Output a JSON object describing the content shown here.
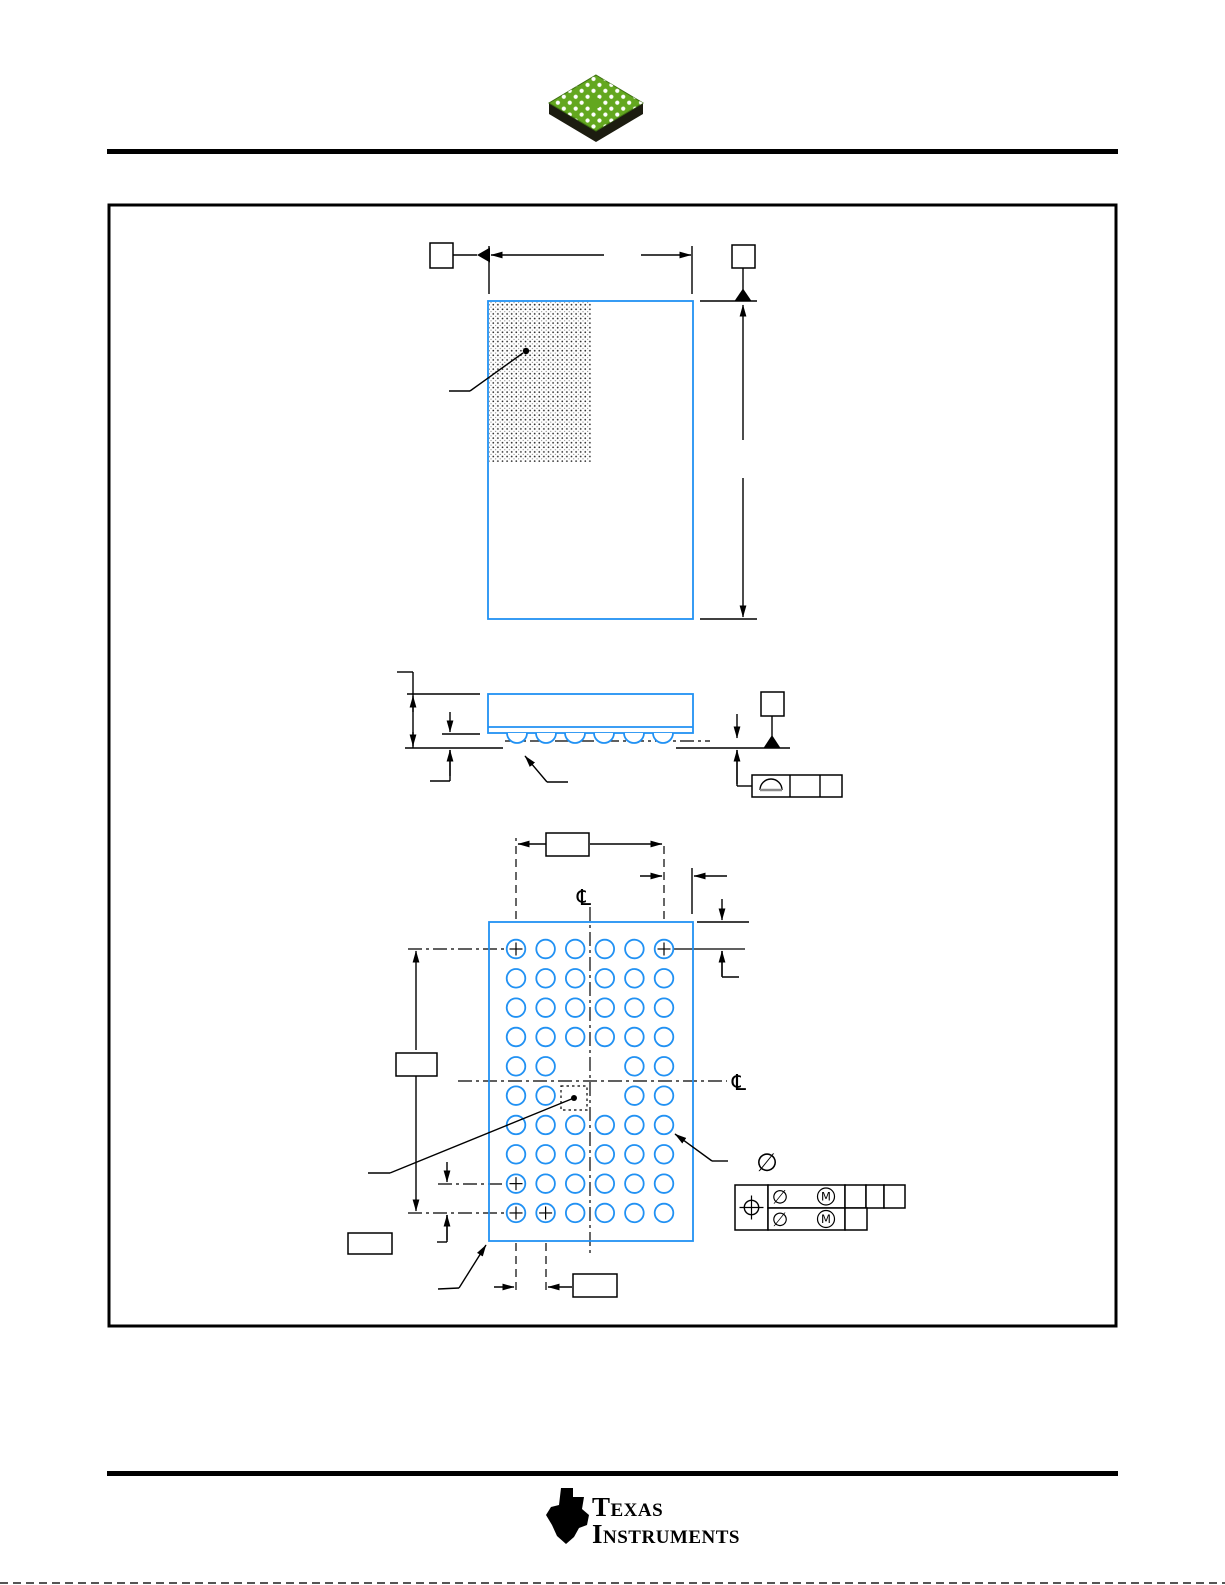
{
  "page": {
    "type": "mechanical-package-outline-page",
    "background": "#ffffff"
  },
  "drawing": {
    "colors": {
      "outline_blue": "#2191f3",
      "line_black": "#000000",
      "chip_green": "#63a71f",
      "chip_shadow": "#1c1c10"
    },
    "symbols": {
      "centerline": "℄",
      "diameter": "∅",
      "max_material_condition": "M",
      "ball_a1_mark": "+"
    },
    "ball_grid": {
      "columns": 6,
      "rows": 10,
      "origin_x": 516,
      "origin_y": 949,
      "pitch_x": 29.6,
      "pitch_y": 29.33,
      "ball_radius": 9.3,
      "plus_mark_size": 13,
      "missing_balls": [
        [
          5,
          3
        ],
        [
          5,
          4
        ],
        [
          6,
          3
        ],
        [
          6,
          4
        ]
      ],
      "plus_marked_balls": [
        [
          1,
          1
        ],
        [
          1,
          6
        ],
        [
          9,
          1
        ],
        [
          10,
          1
        ],
        [
          10,
          2
        ]
      ]
    },
    "side_view": {
      "ball_columns_x": [
        517,
        546,
        575,
        604,
        634,
        663
      ],
      "ball_center_y": 733,
      "ball_radius": 10
    },
    "dimension_labels": {
      "top_width": "",
      "top_height": "",
      "datum_left": "",
      "datum_top_right": "",
      "datum_side": "",
      "ball_span": "",
      "edge_to_column": "",
      "edge_to_row": "",
      "row_span": "",
      "row_pitch": "",
      "column_pitch": "",
      "corner_note": "",
      "seating_plane_tolerance": "",
      "position_tolerance": ""
    }
  },
  "footer": {
    "brand_line1": "Texas",
    "brand_line2": "Instruments"
  }
}
